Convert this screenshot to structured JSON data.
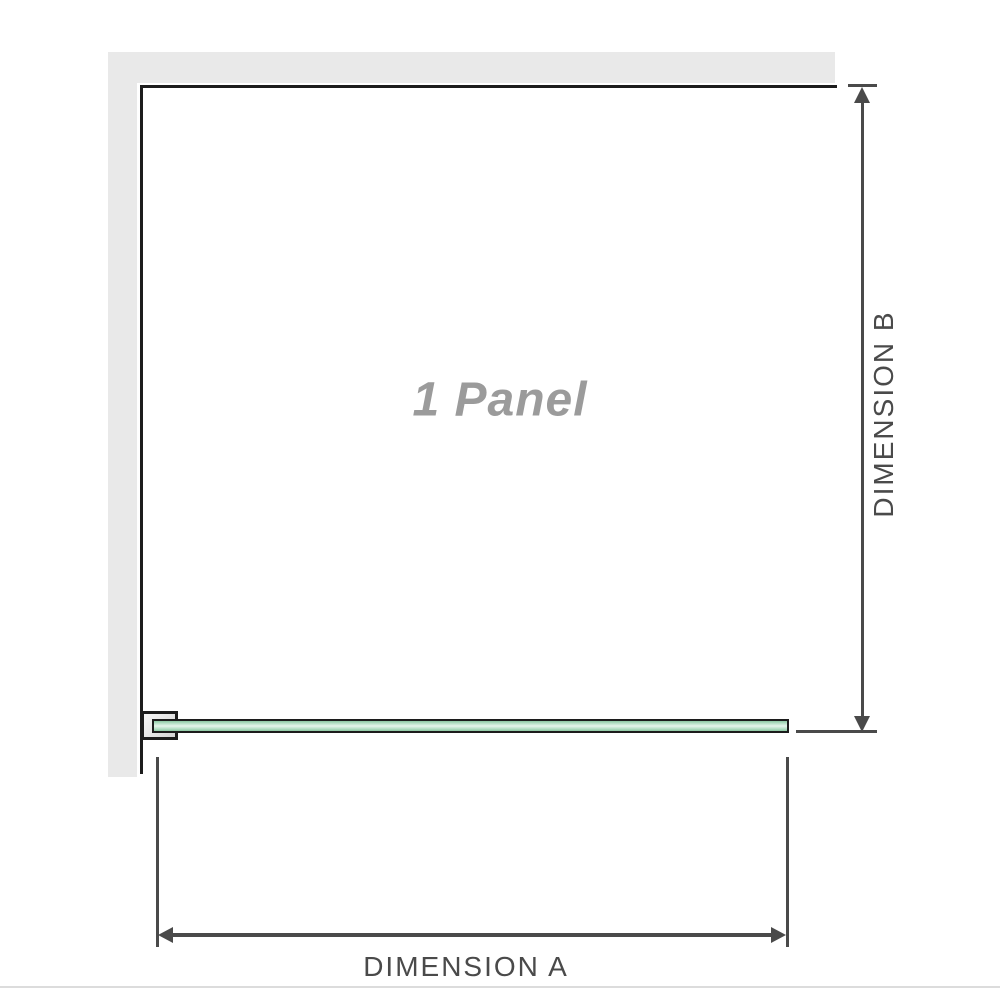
{
  "diagram": {
    "panel_label": "1 Panel",
    "dimension_a_label": "DIMENSION A",
    "dimension_b_label": "DIMENSION B"
  },
  "colors": {
    "background": "#ffffff",
    "wall_gray": "#e9e9e9",
    "outline_black": "#1c1c1c",
    "dimension_gray": "#4a4a4a",
    "panel_label_gray": "#9b9b9b",
    "glass_border": "#1c1c1c",
    "glass_green_dark": "#8cc7a2",
    "glass_green_mid": "#b4dfc5",
    "glass_green_light": "#e6f5ec",
    "bracket_gray_light": "#f7f7f7",
    "bracket_gray_dark": "#d4d4d4",
    "separator_gray": "#dcdcdc"
  }
}
